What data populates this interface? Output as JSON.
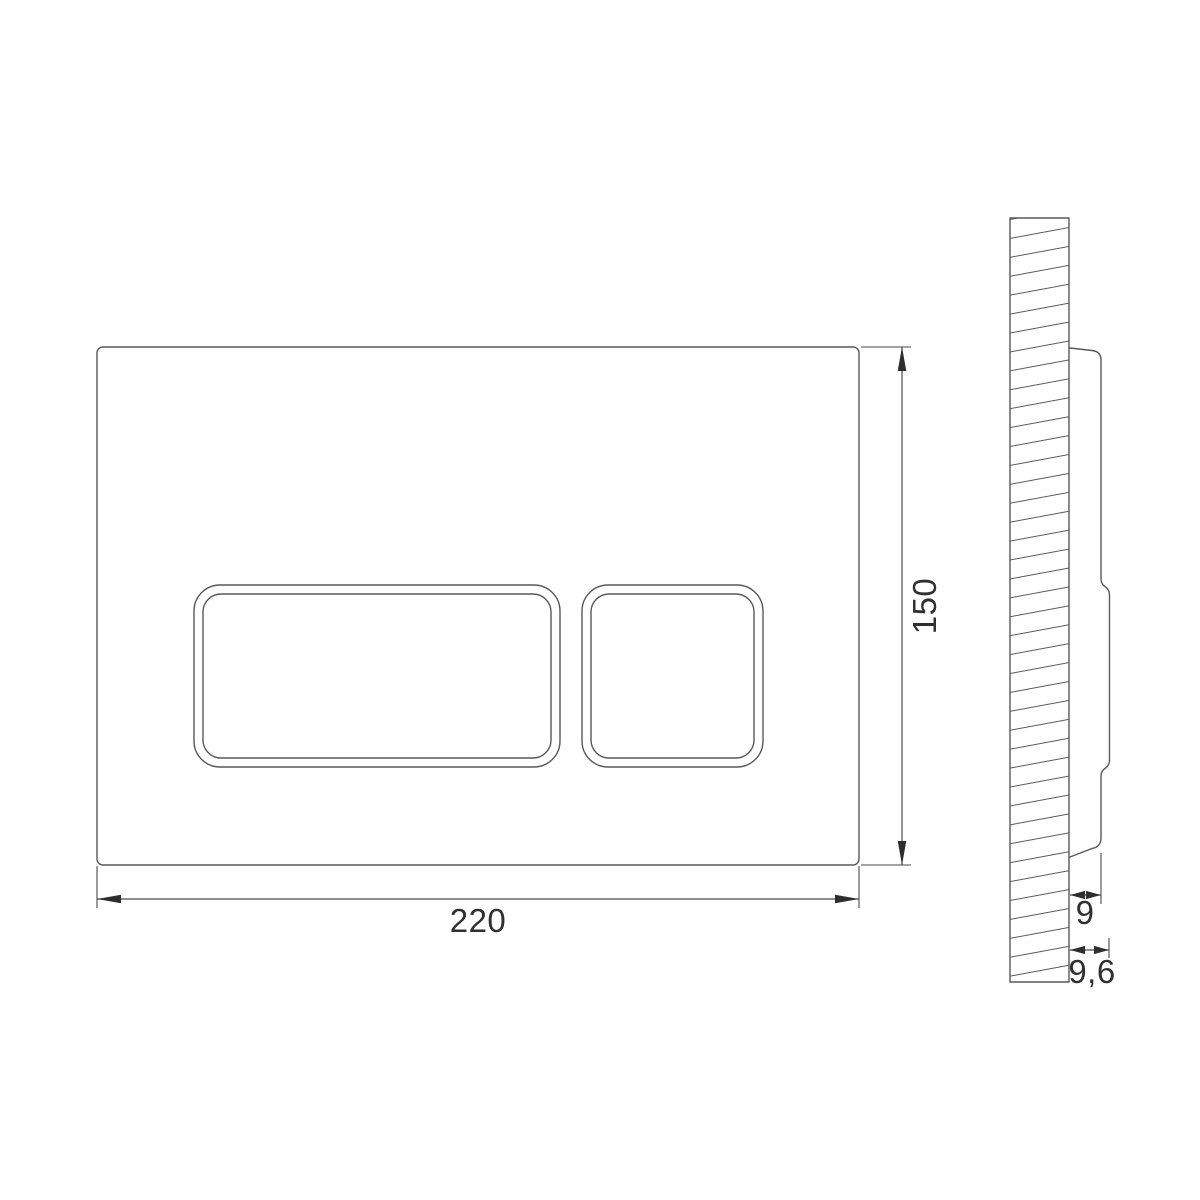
{
  "drawing": {
    "dimensions": {
      "plate_width_mm": "220",
      "plate_height_mm": "150",
      "plate_depth_mm": "9",
      "total_depth_mm": "9,6"
    },
    "colors": {
      "background": "#ffffff",
      "outline": "#59595b",
      "hatch": "#59595b",
      "dimension_line": "#4a4a4c",
      "arrow": "#2e2e30",
      "text": "#303032"
    }
  }
}
